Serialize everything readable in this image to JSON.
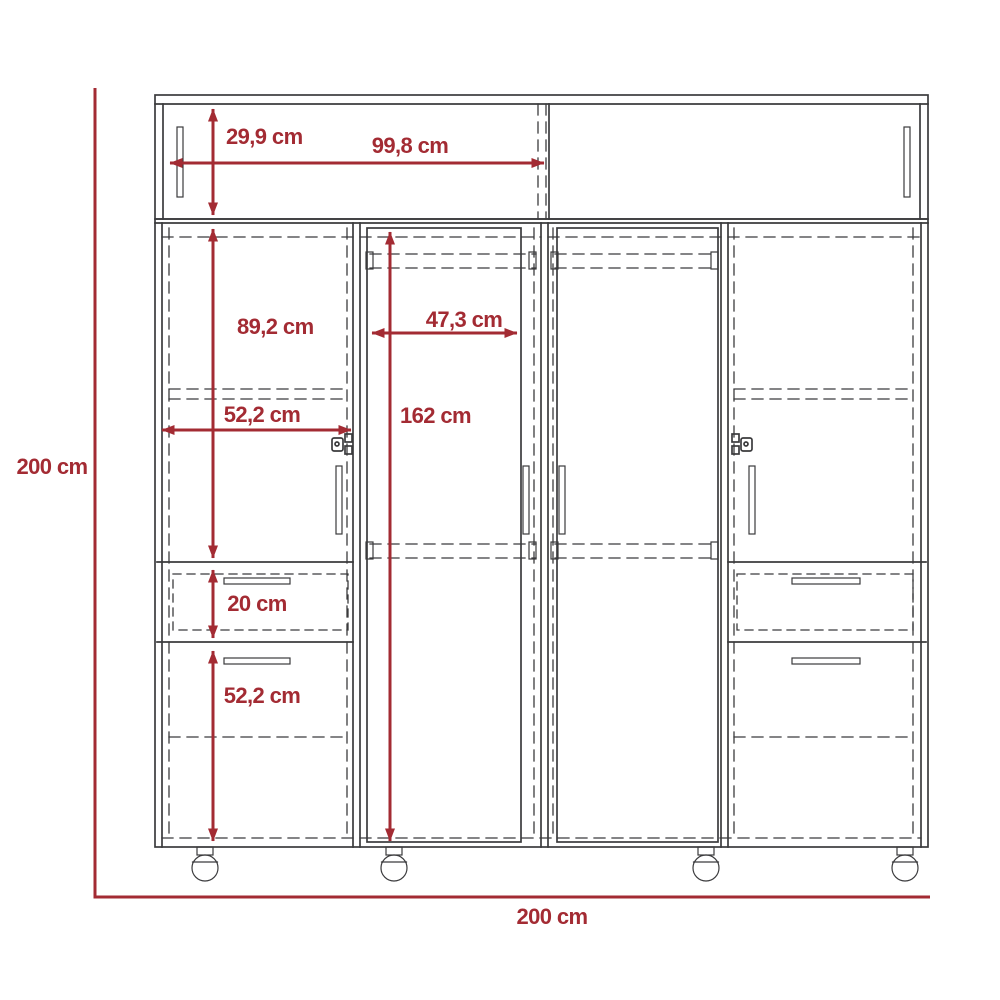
{
  "page": {
    "title": "Wardrobe dimension drawing",
    "background": "#ffffff"
  },
  "colors": {
    "dimension_red": "#a32b33",
    "line_dark": "#3b3b3d"
  },
  "dimensions": {
    "overall_height": "200 cm",
    "overall_width": "200 cm",
    "hutch_height": "29,9 cm",
    "hutch_door_width": "99,8 cm",
    "upper_door_height": "89,2 cm",
    "inner_door_width": "47,3 cm",
    "left_section_width": "52,2 cm",
    "door_height": "162 cm",
    "top_drawer_height": "20 cm",
    "bottom_drawer_height": "52,2 cm"
  }
}
